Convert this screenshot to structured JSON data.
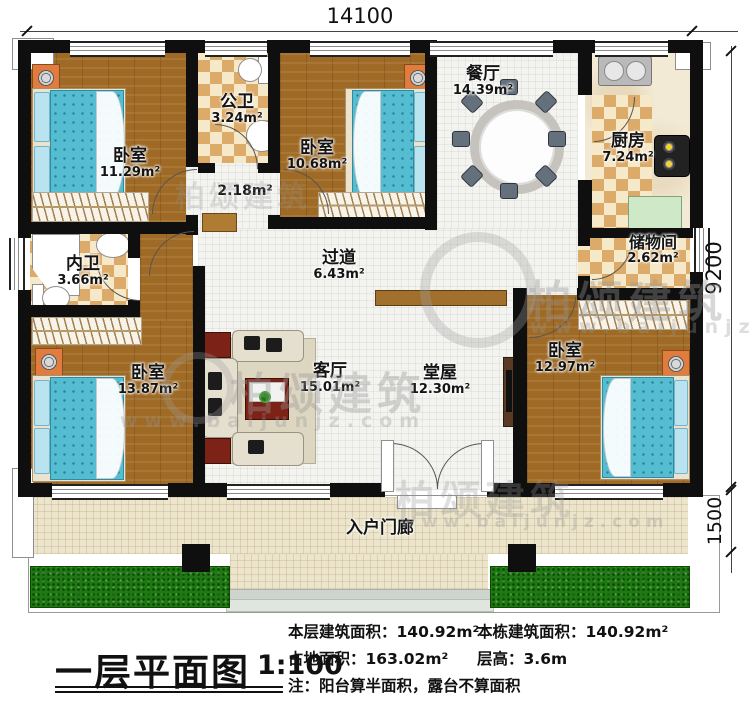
{
  "title": {
    "text": "一层平面图",
    "scale": "1:100"
  },
  "dimensions": {
    "width_top": "14100",
    "height_right": "9200",
    "porch_depth": "1500"
  },
  "rooms": {
    "bedroom_top_left": {
      "name": "卧室",
      "area": "11.29m²"
    },
    "public_bathroom": {
      "name": "公卫",
      "area": "3.24m²"
    },
    "hallway": {
      "area": "2.18m²"
    },
    "bedroom_top_middle": {
      "name": "卧室",
      "area": "10.68m²"
    },
    "dining_room": {
      "name": "餐厅",
      "area": "14.39m²"
    },
    "kitchen": {
      "name": "厨房",
      "area": "7.24m²"
    },
    "storage_room": {
      "name": "储物间",
      "area": "2.62m²"
    },
    "private_bathroom": {
      "name": "内卫",
      "area": "3.66m²"
    },
    "corridor": {
      "name": "过道",
      "area": "6.43m²"
    },
    "bedroom_bottom_left": {
      "name": "卧室",
      "area": "13.87m²"
    },
    "living_room": {
      "name": "客厅",
      "area": "15.01m²"
    },
    "main_hall": {
      "name": "堂屋",
      "area": "12.30m²"
    },
    "bedroom_bottom_right": {
      "name": "卧室",
      "area": "12.97m²"
    },
    "entrance_porch": {
      "name": "入户门廊"
    }
  },
  "info": {
    "floor_area_label": "本层建筑面积：",
    "floor_area_value": "140.92m²",
    "building_area_label": "本栋建筑面积：",
    "building_area_value": "140.92m²",
    "land_area_label": "占地面积：",
    "land_area_value": "163.02m²",
    "floor_height_label": "层高：",
    "floor_height_value": "3.6m",
    "note": "注：阳台算半面积，露台不算面积"
  },
  "watermark": {
    "brand": "柏颂建筑",
    "url": "www.baijunjz.com"
  },
  "colors": {
    "wall": "#0f0f0f",
    "wood_floor": "#9e6a26",
    "tile_light": "#f6e9c9",
    "tile_dark": "#dcab69",
    "bed": "#54bdd2",
    "grass": "#1c7a10",
    "porch": "#ece4cb",
    "accent_red": "#7d2217"
  }
}
